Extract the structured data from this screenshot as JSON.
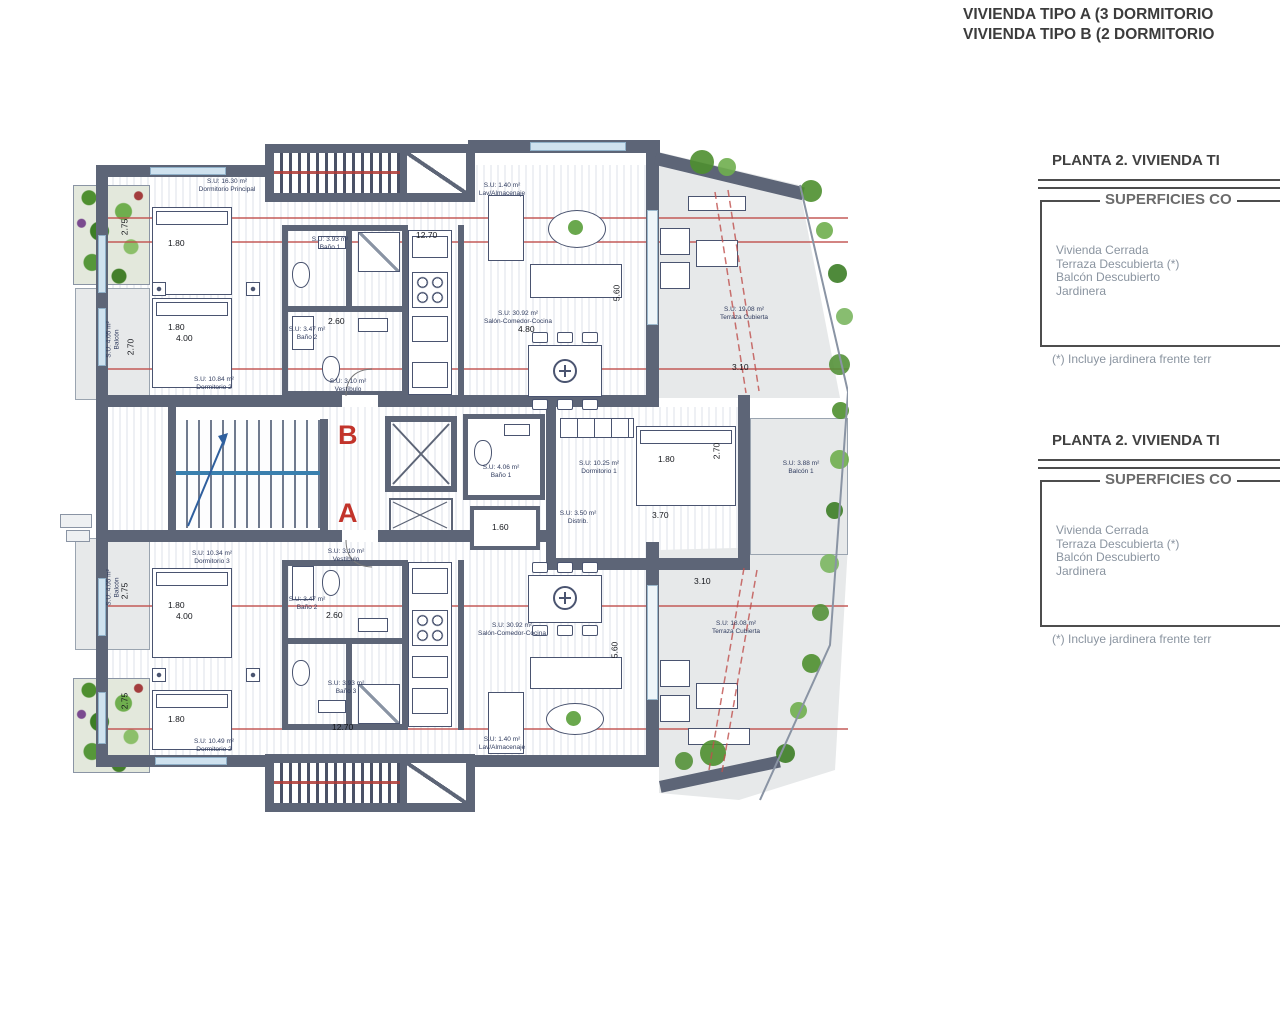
{
  "header": {
    "line1": "VIVIENDA TIPO A (3 DORMITORIO",
    "line2": "VIVIENDA TIPO B (2 DORMITORIO"
  },
  "panels": [
    {
      "title": "PLANTA 2. VIVIENDA TI",
      "subtitle": "SUPERFICIES CO",
      "items": [
        "Vivienda Cerrada",
        "Terraza Descubierta (*)",
        "Balcón Descubierto",
        "Jardinera"
      ],
      "footnote": "(*) Incluye jardinera frente terr"
    },
    {
      "title": "PLANTA 2. VIVIENDA TI",
      "subtitle": "SUPERFICIES CO",
      "items": [
        "Vivienda Cerrada",
        "Terraza Descubierta (*)",
        "Balcón Descubierto",
        "Jardinera"
      ],
      "footnote": "(*) Incluye jardinera frente terr"
    }
  ],
  "plan": {
    "letters": {
      "b": "B",
      "a": "A"
    },
    "labels": {
      "dorm_principal": {
        "area": "S.U: 16.30 m²",
        "name": "Dormitorio Principal"
      },
      "lav": {
        "area": "S.U: 1.40 m²",
        "name": "Lav/Almacenaje"
      },
      "dorm2_b": {
        "area": "S.U: 10.84 m²",
        "name": "Dormitorio 2"
      },
      "bano1_b": {
        "area": "S.U: 3.93 m²",
        "name": "Baño 1"
      },
      "bano2_b": {
        "area": "S.U: 3.47 m²",
        "name": "Baño 2"
      },
      "vestibulo": {
        "area": "S.U: 3.10 m²",
        "name": "Vestíbulo"
      },
      "salon": {
        "area": "S.U: 30.92 m²",
        "name": "Salón-Comedor-Cocina"
      },
      "terraza_b": {
        "area": "S.U: 19.08 m²",
        "name": "Terraza Cubierta"
      },
      "terraza_a": {
        "area": "S.U: 18.08 m²",
        "name": "Terraza Cubierta"
      },
      "dorm1": {
        "area": "S.U: 10.25 m²",
        "name": "Dormitorio 1"
      },
      "balcon1": {
        "area": "S.U: 3.88 m²",
        "name": "Balcón 1"
      },
      "bano1_a": {
        "area": "S.U: 4.06 m²",
        "name": "Baño 1"
      },
      "distrib": {
        "area": "S.U: 3.50 m²",
        "name": "Distrib."
      },
      "dorm3": {
        "area": "S.U: 10.34 m²",
        "name": "Dormitorio 3"
      },
      "dorm2_a": {
        "area": "S.U: 10.49 m²",
        "name": "Dormitorio 2"
      },
      "bano2_a": {
        "area": "S.U: 3.47 m²",
        "name": "Baño 2"
      },
      "bano3_a": {
        "area": "S.U: 3.93 m²",
        "name": "Baño 3"
      },
      "balcon_left": {
        "area": "S.U: 4.05 m²",
        "name": "Balcón"
      }
    },
    "dims": {
      "d1270": "12.70",
      "d180": "1.80",
      "d400": "4.00",
      "d275": "2.75",
      "d270": "2.70",
      "d560": "5.60",
      "d480": "4.80",
      "d310": "3.10",
      "d370": "3.70",
      "d260": "2.60",
      "d160": "1.60"
    },
    "colors": {
      "wall": "#5d6577",
      "red_line": "#c0504d",
      "letter_red": "#c2342b",
      "plant_green": "#5a9e3a",
      "rail_blue": "#3a7fae"
    }
  }
}
